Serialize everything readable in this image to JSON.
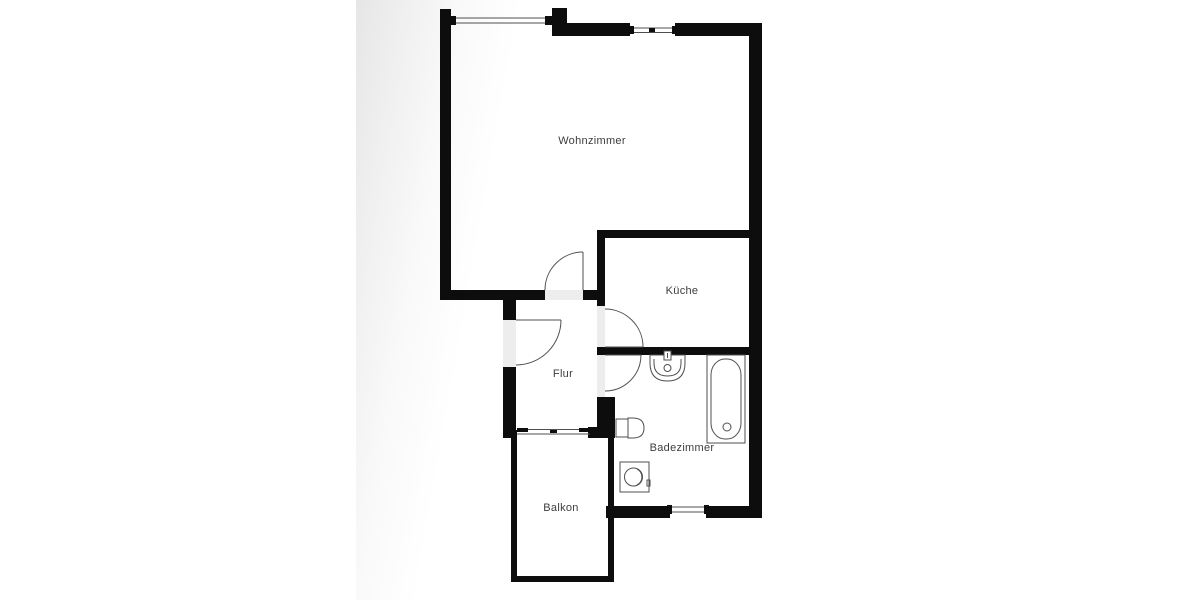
{
  "floorplan": {
    "rooms": [
      {
        "label": "Wohnzimmer"
      },
      {
        "label": "Küche"
      },
      {
        "label": "Flur"
      },
      {
        "label": "Badezimmer"
      },
      {
        "label": "Balkon"
      }
    ],
    "fixtures": [
      "washbasin-icon",
      "bathtub-icon",
      "toilet-icon",
      "washing-machine-icon"
    ],
    "doors": [
      "wohnzimmer-door",
      "entrance-door",
      "kueche-door",
      "badezimmer-door"
    ],
    "windows": [
      "top-left-window",
      "top-right-window",
      "balcony-door-window",
      "badezimmer-window"
    ],
    "colors": {
      "wall": "#0d0d0d",
      "background_tint": "#e6e6e6",
      "threshold": "#ededed",
      "line": "#4f4f4f",
      "label_text": "#3d3d3d"
    }
  }
}
